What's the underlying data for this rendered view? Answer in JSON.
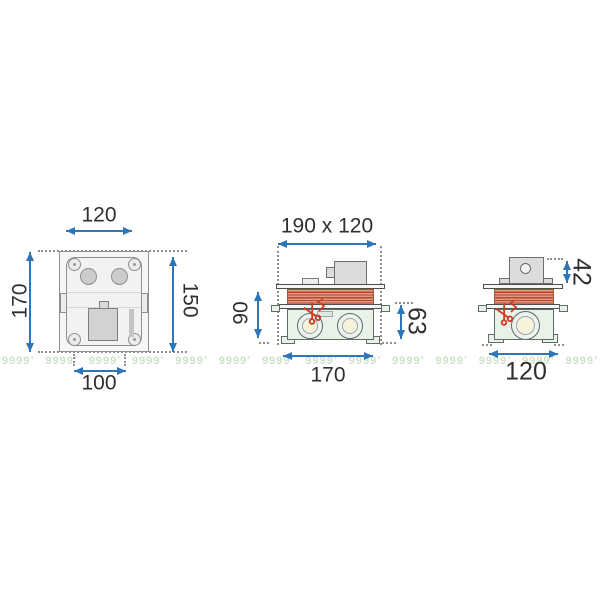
{
  "dims": {
    "front": {
      "top": "120",
      "left": "170",
      "right": "150",
      "bottom": "100"
    },
    "side": {
      "top": "190 x 120",
      "left": "90",
      "right": "63",
      "bottom": "170"
    },
    "end": {
      "right": "42",
      "bottom": "120"
    }
  },
  "icons": {
    "scissors": "cut-here-scissors"
  },
  "watermark": {
    "glyph": "9999ʼ",
    "count": 14
  },
  "colors": {
    "arrow": "#2d76b9",
    "label": "#2f2f2f",
    "stripe-dark": "#b04a30",
    "stripe-light": "#e49a82",
    "body-fill": "#e9f1e9",
    "body-stroke": "#5c6e66",
    "cream": "#f7f2da",
    "gray-fill": "#dcdcdc",
    "gray-stroke": "#6e6e6e",
    "scissors": "#cf3a23",
    "watermark": "#cde3c8",
    "dot": "#8f8f8f"
  }
}
